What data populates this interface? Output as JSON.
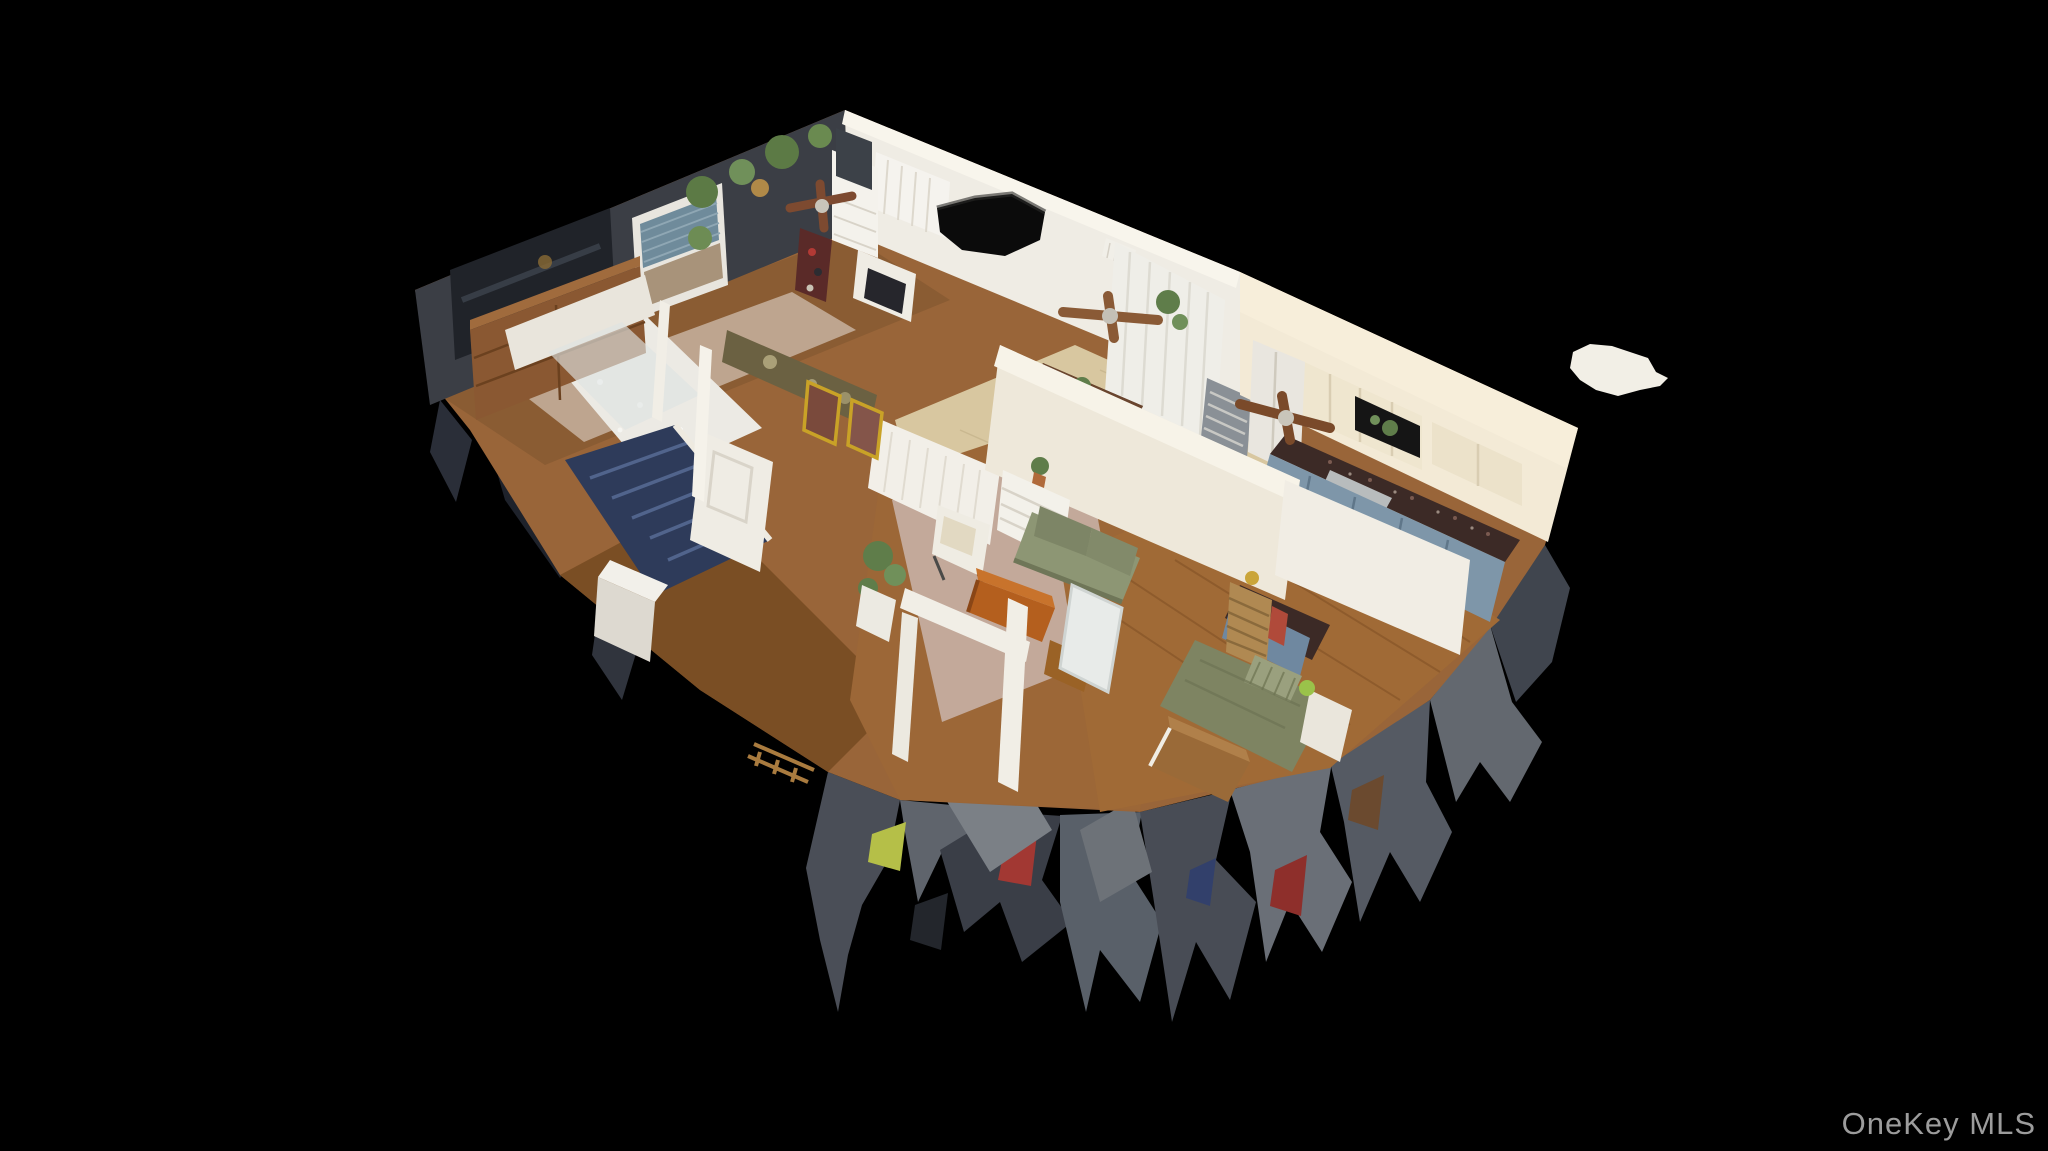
{
  "meta": {
    "type": "real-estate-3d-dollhouse-scan",
    "description": "Isometric cutaway 3D dollhouse scan of a single-story home interior floating on a black background, with ragged scan-mesh debris hanging below the cut floor edges and a small floating white scan artifact to the right of the model."
  },
  "watermark": {
    "text": "OneKey MLS",
    "color": "#9c9c9c"
  },
  "palette": {
    "background": "#000000",
    "wood_floor": "#996539",
    "hall_floor": "#7a4e24",
    "bedroom_floor": "#a06a36",
    "tile_tan": "#d8c7a0",
    "tile_white": "#eceae4",
    "rug_living": "#cab5ab",
    "rug_bedroom": "#c9b6a4",
    "dark_wall": "#3b3e45",
    "white_wall": "#eee8da",
    "cream_wall": "#f3ead6",
    "accent_wall_olive": "#6b6142",
    "cabinet_blue": "#7e96a9",
    "granite": "#3c2a26",
    "sofa_green": "#8d9674",
    "bed_olive": "#7e8462",
    "chest_orange": "#b45f1e",
    "wood_furniture": "#8a5832",
    "stairs_blue": "#2e3b5a",
    "debris_gray": "#565a62",
    "debris_dark": "#3a3e47",
    "debris_red": "#a23833",
    "debris_yellow_green": "#b5bf48",
    "artifact_white": "#f2efe6"
  },
  "scene": {
    "rooms": [
      "bedroom-left-dark-walls",
      "middle-bedroom",
      "bathroom",
      "hallway-with-stairs",
      "dining-area",
      "kitchen",
      "living-room",
      "bedroom-right"
    ],
    "objects": [
      "wall-tv",
      "window-with-blinds",
      "wood-credenza",
      "hanging-plants",
      "white-dresser-with-mirror",
      "ceiling-fans",
      "scan-hole",
      "sheer-curtains",
      "refrigerator",
      "upper-cabinets",
      "granite-counter",
      "kitchen-sink",
      "blue-lower-cabinets",
      "futon-daybed",
      "dining-table",
      "framed-pictures",
      "white-door",
      "washer-box",
      "green-sofa",
      "white-armchair",
      "wood-chest",
      "area-rug",
      "bed-with-olive-bedding",
      "tall-wood-dresser",
      "leaning-mirror",
      "stairs-with-dark-blue-carpet",
      "scan-debris-fringe",
      "floating-scan-artifact"
    ]
  }
}
